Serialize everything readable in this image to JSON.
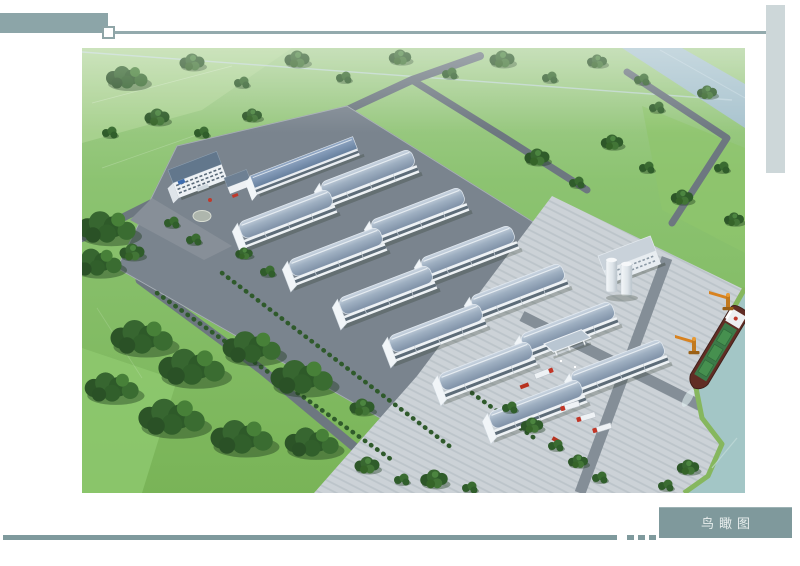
{
  "caption": {
    "label": "鸟瞰图"
  },
  "theme": {
    "accent_teal": "#7f999c",
    "header_bar": "#8ca5a8",
    "side_bar": "#cdd7d9",
    "rule": "#93aaad",
    "caption_text_color": "#e9efee"
  }
}
